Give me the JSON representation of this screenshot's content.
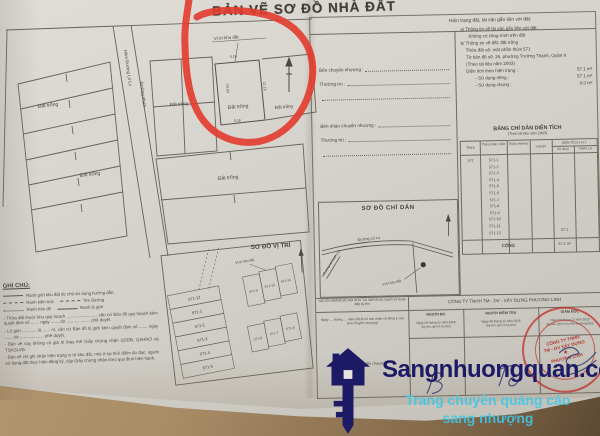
{
  "title": "BẢN VẼ SƠ ĐỒ NHÀ ĐẤT",
  "main_map": {
    "site_pointer": "Vị trí khu đất",
    "road_label_a": "Hẻm Đường Lò Lu",
    "road_label_b": "Đường nhựa",
    "empty_land": "Đất trống",
    "dims": {
      "top": "5.16",
      "right": "11.19",
      "left": "10.93",
      "bottom": "5.16"
    }
  },
  "location_map": {
    "title": "SƠ ĐỒ VỊ TRÍ",
    "site_pointer": "Vị trí khu đất",
    "parcels": [
      "571-12",
      "571-1",
      "571-2",
      "571-3",
      "571-4",
      "571-5",
      "571-9",
      "571-10",
      "571-11",
      "571-6",
      "571-7",
      "571-8"
    ]
  },
  "notes": {
    "title": "GHI CHÚ:",
    "legend": [
      {
        "l1": "Ranh giới khu đất do chủ sử dụng hướng dẫn:"
      },
      {
        "l1": "Ranh kiến trúc",
        "l2": "Tim đường"
      },
      {
        "l1": "Ranh bản đồ",
        "l2": "Ranh lộ giới"
      }
    ],
    "paragraphs": [
      "- Thửa đất thuộc khu quy hoạch .......................... căn cứ Bản đồ quy hoạch kèm quyết định số ....... ngày ....... do .................... phê duyệt.",
      "- Lộ giới ............ là ...... m, căn cứ Bản đồ lộ giới kèm quyết định số ....... ngày ....... do .................... phê duyệt.",
      "- Bản vẽ này không có giá trị thay thế Giấy chứng nhận QSDĐ, QSHNƠ và TSKGLVĐ.",
      "- Bản vẽ chỉ ghi nhận hiện trạng vị trí khu đất, nhà ở tại thời điểm đo đạc; người sử dụng đất thực hiện đăng ký, cấp Giấy chứng nhận theo quy định hiện hành."
    ]
  },
  "panel": {
    "header": "Hiện trạng đất, tài sản gắn liền với đất:",
    "transfer": {
      "seller": "Bên chuyển nhượng :",
      "residence1": "Thường trú :",
      "buyer": "Bên nhận chuyển nhượng :",
      "residence2": "Thường trú :"
    },
    "info": {
      "a_title": "a/ Thông tin về tài sản gắn liền với đất:",
      "a_text": "Không có công trình trên đất",
      "b_title": "b/ Thông tin về đất: đất trống",
      "line1": "Thửa đất số: một phần thửa 571",
      "line2": "Tờ bản đồ số: 26, phường Trường Thạnh, Quận 9",
      "line3": "(Theo tài liệu năm 2003)",
      "area_label": "Diện tích theo hiện trạng :",
      "area_value": "57.1  m²",
      "private_label": "- Sử dụng riêng :",
      "private_value": "57.1  m²",
      "shared_label": "- Sử dụng chung :",
      "shared_value": "0,0  m²"
    },
    "area_table": {
      "title": "BẢNG CHỈ DẪN DIỆN TÍCH",
      "subtitle": "(Theo tài liệu năm 2003)",
      "col_thua": "Thửa",
      "col_split": "Thửa phân chiết",
      "col_adjust": "Thửa chỉnh lý",
      "col_type": "Loại gò",
      "col_area": "DIỆN TÍCH ( m² )",
      "col_use": "Sử dụng",
      "col_lg": "Chiếm LG",
      "parent": "571",
      "rows": [
        "571-1",
        "571-2",
        "571-3",
        "571-4",
        "571-5",
        "571-6",
        "571-7",
        "571-8",
        "571-9",
        "571-10",
        "571-11",
        "571-12"
      ],
      "area_value": "57.1",
      "total_label": "CỘNG",
      "total_value": "57.1 m²"
    },
    "guide": {
      "title": "SƠ ĐỒ CHỈ DẪN",
      "road_main": "Đường Lò Lu",
      "road_side": "Đường Lã Xuân Oai",
      "site_label": "Vị trí khu đất"
    },
    "sign": {
      "left_header": "NGƯỜI NHẬN/CHỦ SỞ HỮU TÀI SẢN (hoặc người sử dụng đất) ký tên",
      "left_date": "Ngày .... tháng .... năm 2018 (có xác nhận và đồng ý của bên chuyển nhượng)",
      "left_footer": "Bên nhận chuyển nhượng",
      "company": "CÔNG TY TNHH TM - DV - XÂY DỰNG PHƯƠNG LINH",
      "col_measure": "NGƯỜI ĐO",
      "col_check": "NGƯỜI KIỂM TRA",
      "col_director": "GIÁM ĐỐC",
      "date": "Ngày 08 tháng 12 năm 2018",
      "date_sub": "(ký tên, ghi rõ họ tên)",
      "date_sub_director": "(ký tên, ghi rõ họ tên và đóng dấu)",
      "stamp": {
        "line1": "CÔNG TY TNHH",
        "line2": "TM - DV XÂY DỰNG",
        "line3": "PHƯƠNG LINH"
      }
    }
  },
  "watermark": {
    "brand": "Sangnhuongquan.com",
    "tagline1": "Trang chuyên quảng cáo",
    "tagline2": "sang nhượng"
  },
  "colors": {
    "annotation_red": "#e23b2c",
    "stamp_red": "#c03a32",
    "watermark_navy": "#1d1a66",
    "watermark_cyan": "#3fc6e6"
  }
}
